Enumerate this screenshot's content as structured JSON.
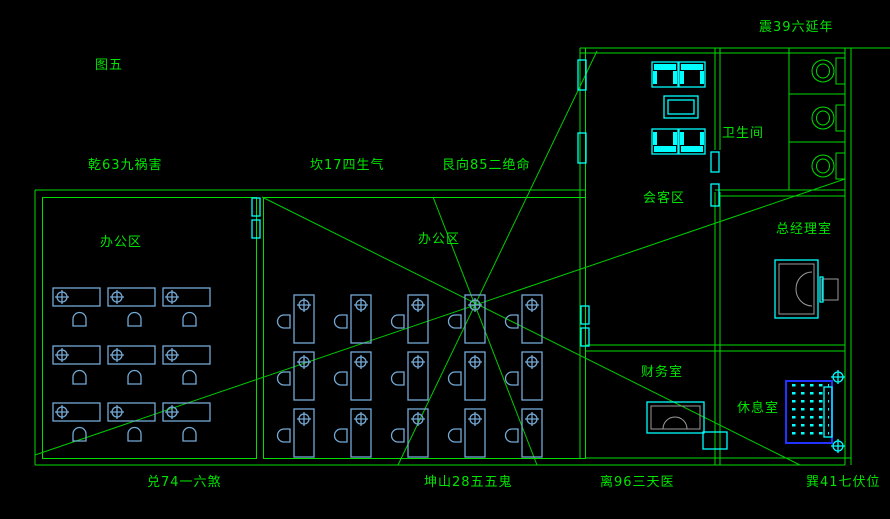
{
  "figure_label": "图五",
  "feng_shui_labels": {
    "qian": "乾63九祸害",
    "kan": "坎17四生气",
    "gen": "艮向85二绝命",
    "zhen": "震39六延年",
    "dui": "兑74一六煞",
    "kun": "坤山28五五鬼",
    "li": "离96三天医",
    "xun": "巽41七伏位"
  },
  "rooms": {
    "office_left": "办公区",
    "office_middle": "办公区",
    "meeting": "会客区",
    "bathroom": "卫生间",
    "gm_office": "总经理室",
    "finance": "财务室",
    "lounge": "休息室"
  },
  "colors": {
    "background": "#000000",
    "wall": "#00dd00",
    "ray": "#00cc00",
    "text": "#00e400",
    "desk": "#74aad6",
    "cyan": "#00ffff",
    "gray": "#9a9a9a",
    "bed": "#2233ff"
  }
}
